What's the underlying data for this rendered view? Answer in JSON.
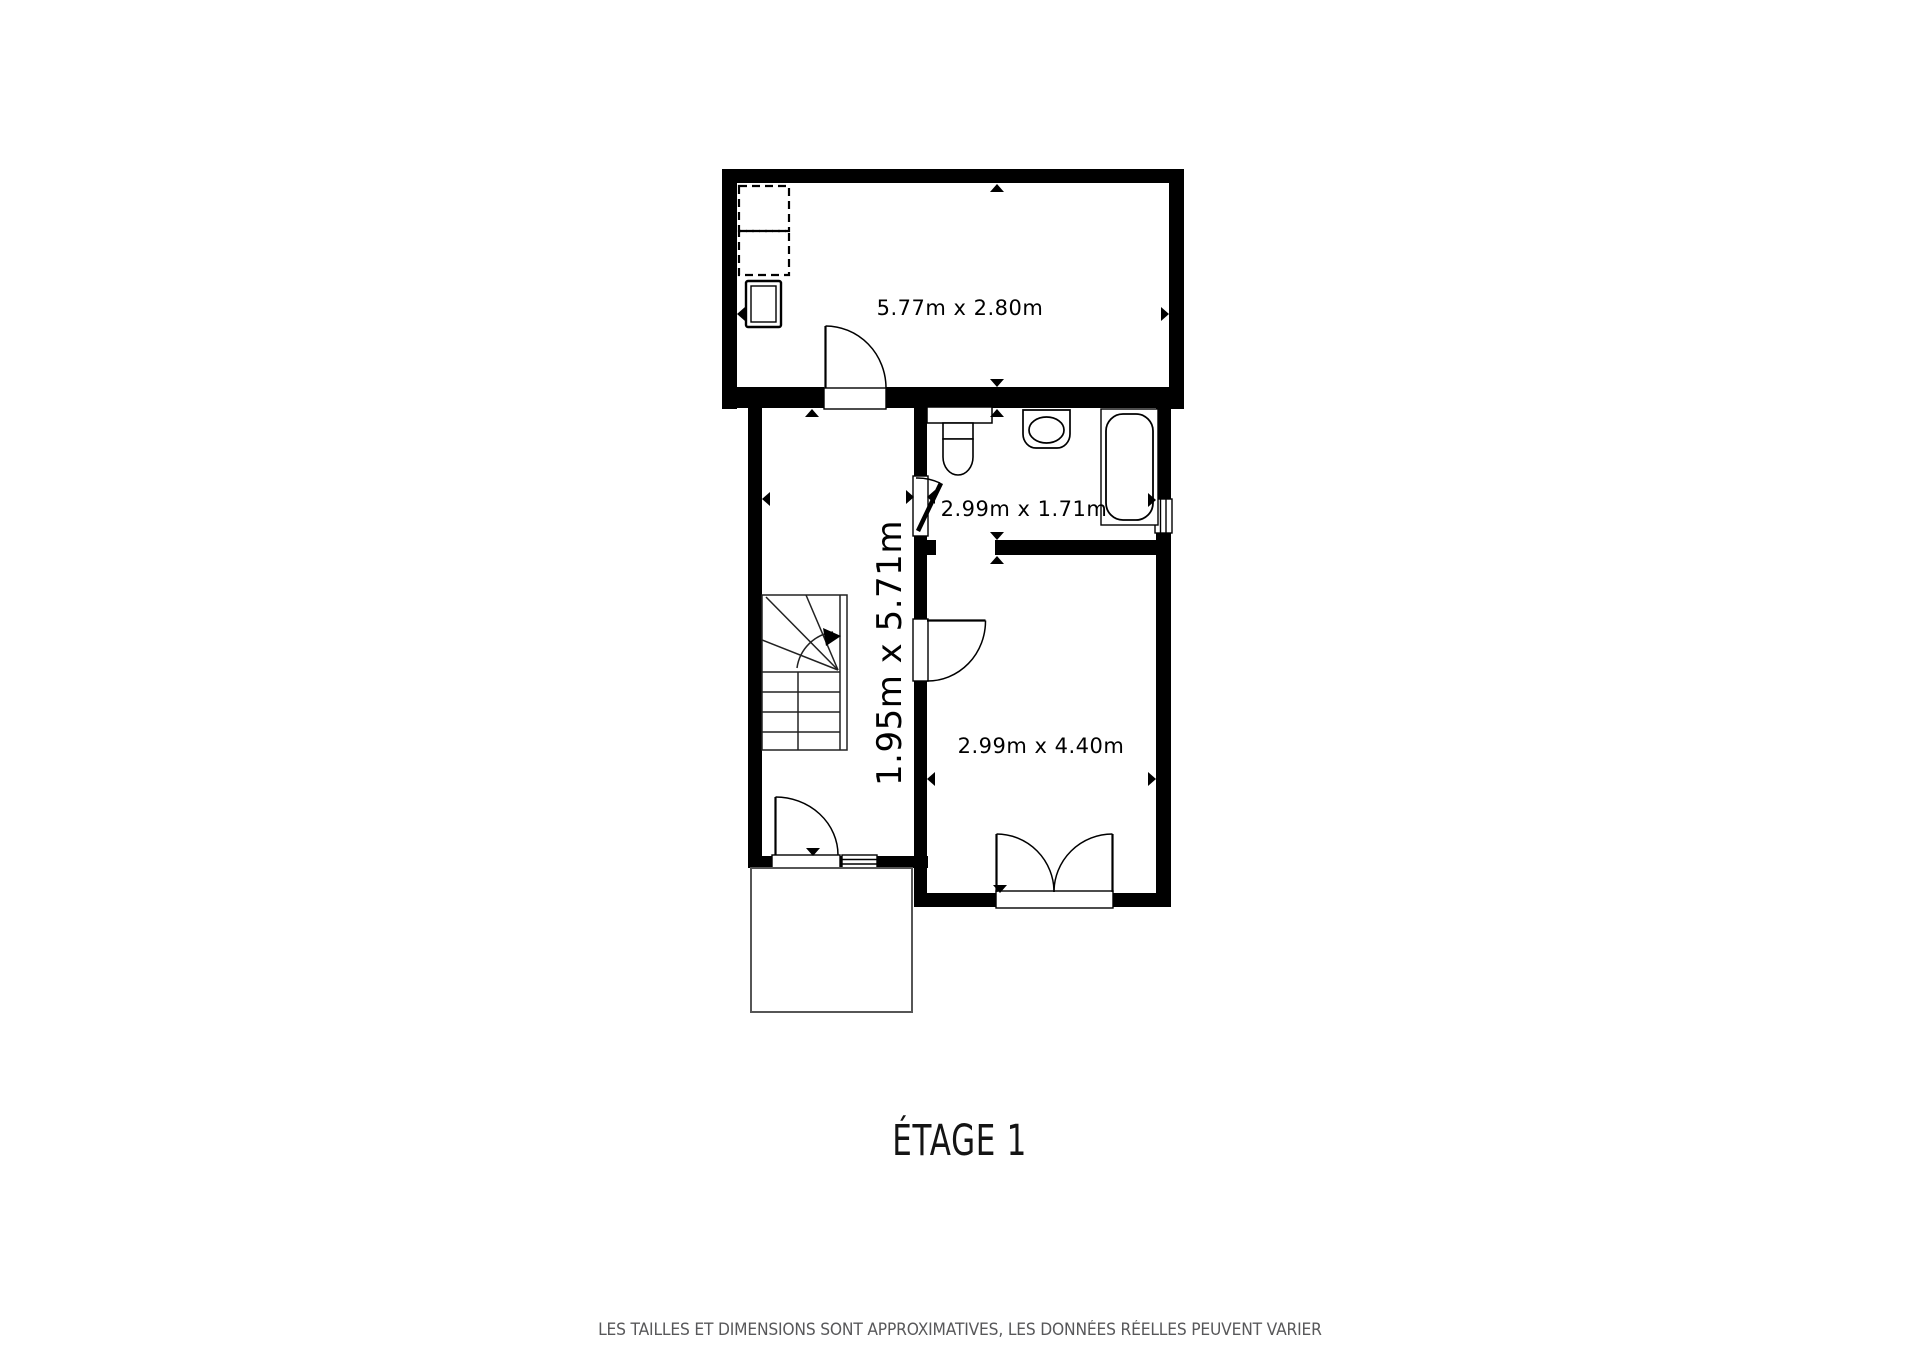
{
  "floor": {
    "title": "ÉTAGE 1"
  },
  "rooms": {
    "top_room": {
      "dimensions": "5.77m x 2.80m"
    },
    "bathroom": {
      "dimensions": "2.99m x 1.71m"
    },
    "hallway": {
      "dimensions": "1.95m x 5.71m"
    },
    "bottom_room": {
      "dimensions": "2.99m x 4.40m"
    }
  },
  "footer": {
    "disclaimer": "LES TAILLES ET DIMENSIONS SONT APPROXIMATIVES, LES DONNÉES RÉELLES PEUVENT VARIER"
  },
  "colors": {
    "wall": "#000000",
    "background": "#ffffff",
    "label": "#000000",
    "disclaimer": "#58585a"
  }
}
